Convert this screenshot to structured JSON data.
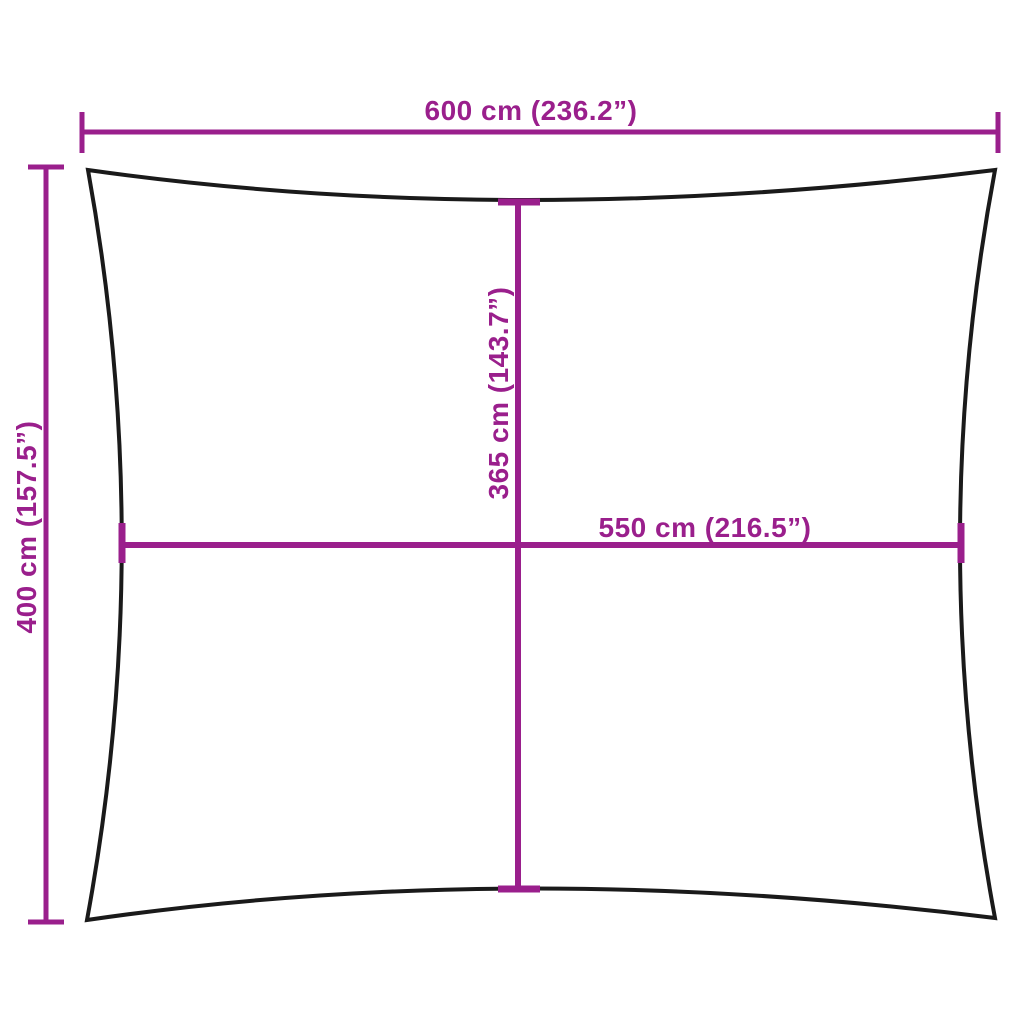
{
  "diagram": {
    "kind": "product-dimension-diagram",
    "shape": "rectangle-with-concave-edges",
    "background_color": "#FFFFFF",
    "outline_color": "#1A1A1A",
    "dimension_color": "#9A1F8C"
  },
  "dimensions": {
    "top_width": {
      "value_cm": 600,
      "value_in": 236.2,
      "label": "600 cm (236.2”)"
    },
    "left_height": {
      "value_cm": 400,
      "value_in": 157.5,
      "label": "400 cm (157.5”)"
    },
    "center_height": {
      "value_cm": 365,
      "value_in": 143.7,
      "label": "365 cm (143.7”)"
    },
    "center_width": {
      "value_cm": 550,
      "value_in": 216.5,
      "label": "550 cm (216.5”)"
    }
  }
}
